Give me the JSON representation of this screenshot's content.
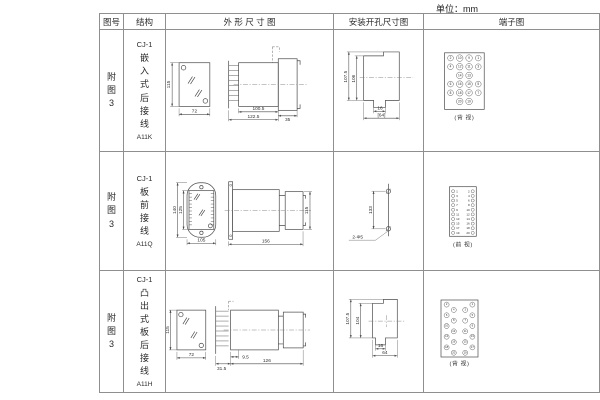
{
  "unit_label": "单位：mm",
  "headers": {
    "figure_no": "图号",
    "structure": "结构",
    "outline": "外 形 尺 寸 图",
    "mounting": "安装开孔尺寸图",
    "terminal": "端子图"
  },
  "rows": [
    {
      "figure_no": "附图3",
      "structure": {
        "model": "CJ-1",
        "desc": "嵌入式后接线",
        "code": "A11K"
      },
      "outline_dims": {
        "height": "115",
        "width": "72",
        "body_len": "100.5",
        "total_len": "122.5",
        "rear_len": "35"
      },
      "mounting_dims": {
        "outer_h": "107.5",
        "inner_h": "106",
        "slot_w": "16",
        "cutout_w": "[64]"
      },
      "terminal": {
        "caption": "(背 视)",
        "grid": [
          [
            "2",
            "10",
            "9",
            "1"
          ],
          [
            "4",
            "12",
            "11",
            "3"
          ],
          [
            "14",
            "13"
          ],
          [
            "6",
            "16",
            "15",
            "5"
          ],
          [
            "8",
            "18",
            "17",
            "7"
          ],
          [
            "20",
            "19"
          ]
        ]
      }
    },
    {
      "figure_no": "附图3",
      "structure": {
        "model": "CJ-1",
        "desc": "板前接线",
        "code": "A11Q"
      },
      "outline_dims": {
        "outer_h": "140",
        "inner_h": "125",
        "width": "105",
        "length": "156",
        "height": "115"
      },
      "mounting_dims": {
        "hole_pitch": "133",
        "hole_spec": "2-Φ5"
      },
      "terminal": {
        "caption": "(前 视)",
        "left": [
          "1",
          "3",
          "5",
          "7",
          "9",
          "11",
          "13",
          "15",
          "17",
          "19"
        ],
        "right": [
          "2",
          "4",
          "6",
          "8",
          "10",
          "12",
          "14",
          "16",
          "18",
          "20"
        ]
      }
    },
    {
      "figure_no": "附图3",
      "structure": {
        "model": "CJ-1",
        "desc": "凸出式板后接线",
        "code": "A11H"
      },
      "outline_dims": {
        "height": "115",
        "width": "72",
        "pin_len": "9.5",
        "socket_len": "31.5",
        "total_len": "126"
      },
      "mounting_dims": {
        "outer_h": "107.5",
        "inner_h": "104",
        "slot_w": "16",
        "cutout_w": "64"
      },
      "terminal": {
        "caption": "(背 视)",
        "left": [
          "2",
          "4",
          "6",
          "8",
          "10",
          "12",
          "14",
          "16",
          "18",
          "20"
        ],
        "right": [
          "1",
          "3",
          "5",
          "7",
          "9",
          "11",
          "13",
          "15",
          "17",
          "19"
        ]
      }
    }
  ]
}
